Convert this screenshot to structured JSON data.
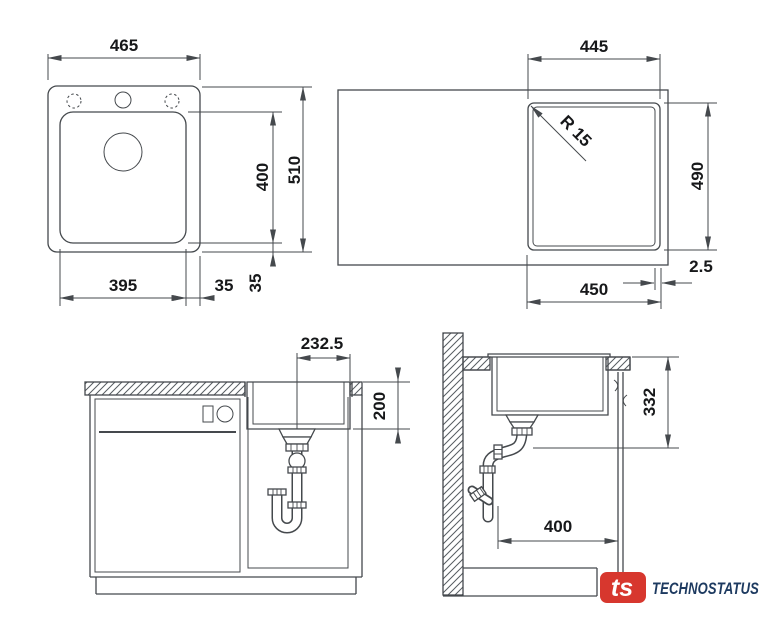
{
  "drawing": {
    "stroke_color": "#45494d",
    "views": {
      "sink_plan": {
        "overall_width": "465",
        "bowl_length": "400",
        "overall_length": "510",
        "bowl_width": "395",
        "bowl_right_offset": "35",
        "bowl_bottom_offset": "35"
      },
      "cutout_plan": {
        "cutout_width": "445",
        "corner_radius": "R 15",
        "cutout_length": "490",
        "bowl_width": "450",
        "reveal": "2.5"
      },
      "front_view": {
        "drain_offset": "232.5",
        "bowl_depth": "200"
      },
      "side_view": {
        "installation_depth": "332",
        "clearance": "400"
      }
    }
  },
  "branding": {
    "monogram": "ts",
    "company": "TECHNOSTATUS",
    "red": "#d7372e",
    "navy": "#1d3a60"
  }
}
